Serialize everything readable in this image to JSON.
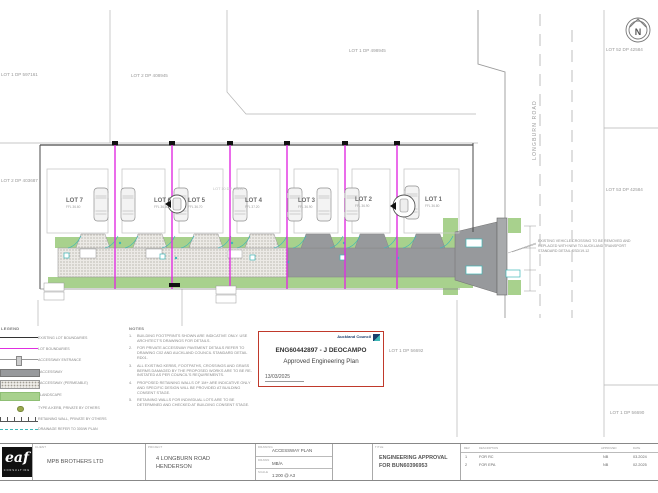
{
  "plan": {
    "north_label": "N",
    "road_name": "LONGBURN ROAD",
    "parcel_labels": {
      "top_left": "LOT 1 DP 597161",
      "mid_left": "LOT 2 DP 403687",
      "top_center": "LOT 2 DP 408945",
      "top_right": "LOT 1 DP 498945",
      "right_upper": "LOT 52 DP 42584",
      "right_middle": "LOT 53 DP 42584",
      "lower_center": "LOT 1 DP 56692",
      "lower_right": "LOT 1 DP 56690",
      "site_parent": "LOT 10 DP 40894"
    },
    "lots": [
      {
        "name": "LOT 7",
        "ffl": "FFL 36.60"
      },
      {
        "name": "LOT 6",
        "ffl": "FFL 36.60"
      },
      {
        "name": "LOT 5",
        "ffl": "FFL 36.70"
      },
      {
        "name": "LOT 4",
        "ffl": "FFL 37.20"
      },
      {
        "name": "LOT 3",
        "ffl": "FFL 36.90"
      },
      {
        "name": "LOT 2",
        "ffl": "FFL 36.90"
      },
      {
        "name": "LOT 1",
        "ffl": "FFL 36.80"
      }
    ],
    "crossing_note": [
      "EXISTING VEHICLE CROSSING TO BE REMOVED AND",
      "REPLACED WITH NEW TO AUCKLAND TRANSPORT",
      "STANDARD DETAIL SSD/19-12"
    ],
    "colors": {
      "lot_boundary": "#e02ee0",
      "landscape": "#a8d18d",
      "accessway": "#97999c",
      "drainage": "#3fb7b7",
      "stamp_border": "#c0392b"
    }
  },
  "legend": {
    "title": "LEGEND",
    "items": [
      {
        "swatch": "line-black-icon",
        "label": "EXISTING LOT BOUNDARIES"
      },
      {
        "swatch": "line-magenta-icon",
        "label": "LOT BOUNDARIES"
      },
      {
        "swatch": "entrance-icon",
        "label": "ACCESSWAY ENTRANCE"
      },
      {
        "swatch": "bar-gray-icon",
        "label": "ACCESSWAY"
      },
      {
        "swatch": "bar-dots-icon",
        "label": "ACCESSWAY (PERMEABLE)"
      },
      {
        "swatch": "bar-green-icon",
        "label": "LANDSCAPE"
      },
      {
        "swatch": "kerb-dot-icon",
        "label": "TYPE A KERB, PRIVATE BY OTHERS"
      },
      {
        "swatch": "wall-icon",
        "label": "RETAINING WALL, PRIVATE BY OTHERS"
      },
      {
        "swatch": "line-teal-icon",
        "label": "DRAINAGE REFER TO 300/W PLAN"
      }
    ]
  },
  "notes": {
    "title": "NOTES",
    "items": [
      {
        "num": "1.",
        "text": "BUILDING FOOTPRINTS SHOWN ARE INDICATIVE ONLY. USE ARCHITECT'S DRAWINGS FOR DETAILS."
      },
      {
        "num": "2.",
        "text": "FOR PRIVATE ACCESSWAY PAVEMENT DETAILS REFER TO DRAWING C02 AND AUCKLAND COUNCIL STANDARD DETAIL RD01."
      },
      {
        "num": "3.",
        "text": "ALL EXISTING KERBS, FOOTPATHS, CROSSINGS AND GRASS BERMS DAMAGED BY THE PROPOSED WORKS ARE TO BE RE-INSTATED AS PER COUNCIL'S REQUIREMENTS."
      },
      {
        "num": "4.",
        "text": "PROPOSED RETAINING WALLS OF 1M+ ARE INDICATIVE ONLY AND SPECIFIC DESIGN WILL BE PROVIDED AT BUILDING CONSENT STAGE."
      },
      {
        "num": "5.",
        "text": "RETAINING WALLS FOR INDIVIDUAL LOTS ARE TO BE DETERMINED AND CHECKED AT BUILDING CONSENT STAGE."
      }
    ]
  },
  "stamp": {
    "authority": "Auckland Council",
    "reference": "ENG60442897 - J DEOCAMPO",
    "status": "Approved Engineering Plan",
    "date": "13/03/2025"
  },
  "titleblock": {
    "logo": {
      "text": "eaf",
      "sub": "CONSULTING"
    },
    "client": {
      "label": "CLIENT",
      "value": "MPB BROTHERS LTD"
    },
    "project": {
      "label": "PROJECT",
      "line1": "4 LONGBURN ROAD",
      "line2": "HENDERSON"
    },
    "fields": [
      {
        "label": "DRAWING",
        "value": "ACCESSWAY PLAN"
      },
      {
        "label": "DRAWN",
        "value": "MB/A"
      },
      {
        "label": "SCALE",
        "value": "1:200 @ A3"
      }
    ],
    "title": {
      "label": "TITLE",
      "line1": "ENGINEERING APPROVAL",
      "line2": "FOR BUN60396953"
    },
    "revisions": {
      "headers": [
        "REV",
        "DESCRIPTION",
        "APPROVED",
        "DATE"
      ],
      "rows": [
        [
          "1",
          "FOR RC",
          "NB",
          "03.2024"
        ],
        [
          "2",
          "FOR EPA",
          "NB",
          "02.2025"
        ]
      ]
    }
  }
}
